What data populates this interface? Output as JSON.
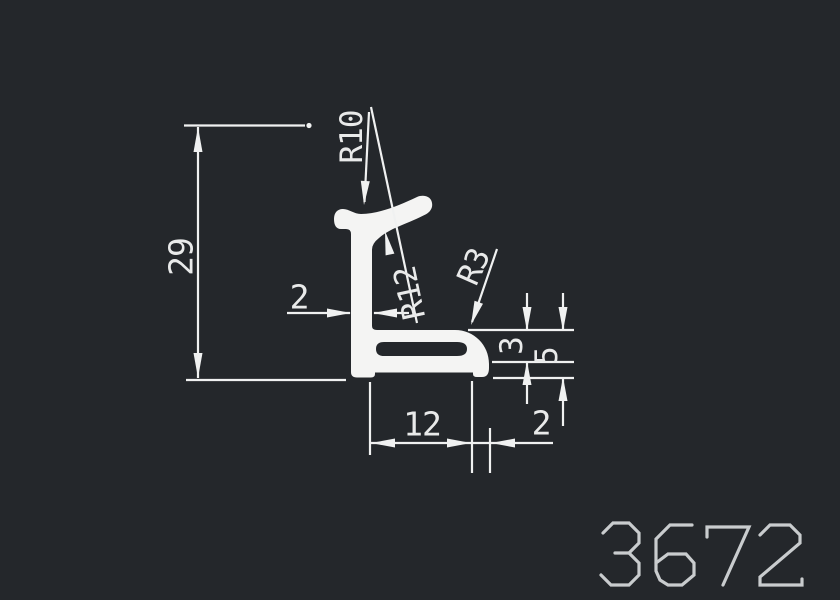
{
  "drawing": {
    "title": "aluminium-profile-cross-section",
    "part_number": "3672",
    "colors": {
      "background": "#24272b",
      "line": "#f0f1f1",
      "text": "#e9eaea",
      "part_number": "#c9ccce"
    },
    "dimensions": {
      "overall_height": "29",
      "stem_thickness": "2",
      "radius_top": "R10",
      "radius_underside": "R12",
      "radius_foot_corner": "R3",
      "foot_step_height": "3",
      "foot_total_height": "5",
      "foot_width": "12",
      "lip_thickness": "2"
    }
  }
}
